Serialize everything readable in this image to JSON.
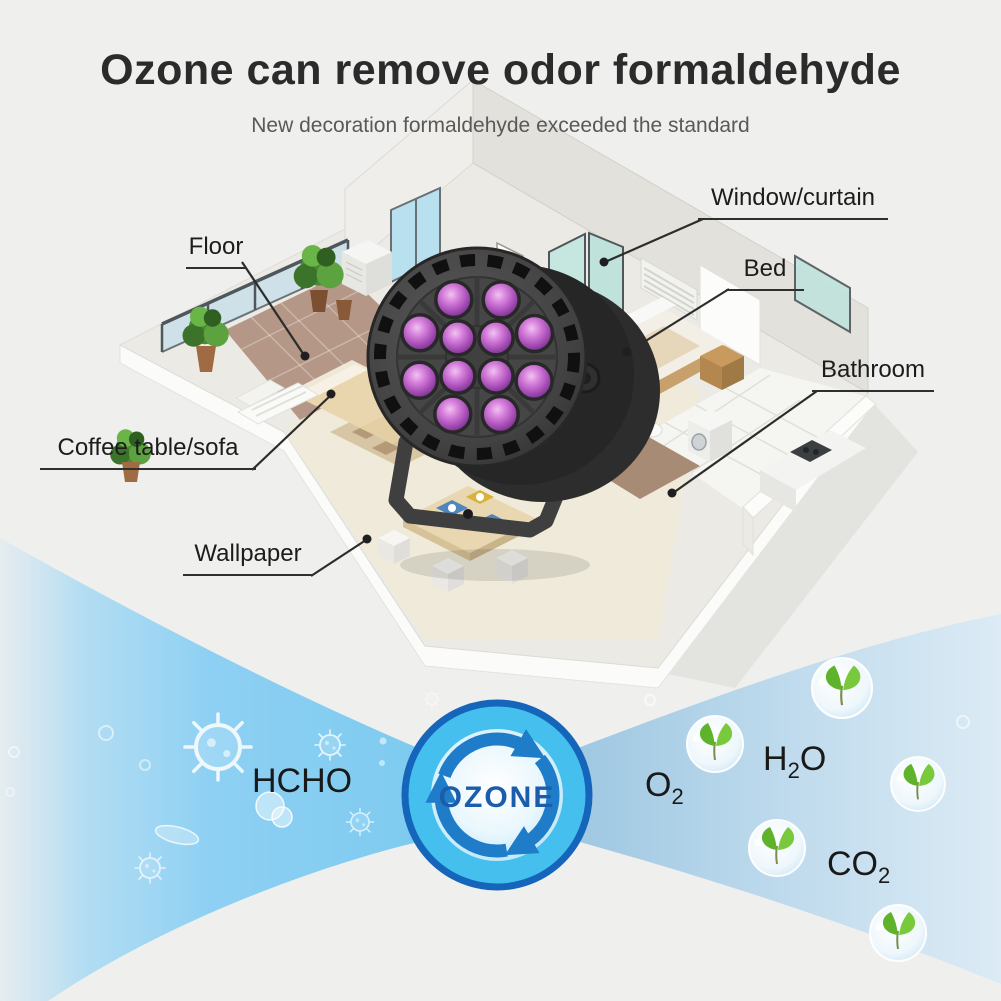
{
  "header": {
    "title": "Ozone can remove odor formaldehyde",
    "subtitle": "New decoration formaldehyde exceeded the standard"
  },
  "house_labels": {
    "floor": "Floor",
    "window_curtain": "Window/curtain",
    "bed": "Bed",
    "bathroom": "Bathroom",
    "coffee_table_sofa": "Coffee table/sofa",
    "wallpaper": "Wallpaper"
  },
  "process": {
    "input_gas": "HCHO",
    "generator_label": "OZONE",
    "outputs": {
      "o2": {
        "base": "O",
        "sub": "2"
      },
      "h2o": {
        "part1": "H",
        "sub": "2",
        "part2": "O"
      },
      "co2": {
        "base": "CO",
        "sub": "2"
      }
    }
  },
  "colors": {
    "background": "#efefee",
    "title_text": "#2b2b2b",
    "subtitle_text": "#595959",
    "label_text": "#1c1c1c",
    "formula_text": "#191919",
    "ozone_text": "#1b5cab",
    "ozone_ring": "#1565bb",
    "ozone_fill": "#45bfee",
    "arrow_blue": "#1e7cc9",
    "band_left_blue": "#7ecbf0",
    "band_right_blue": "#bcd9ec",
    "led_purple": "#a94fb8",
    "lamp_body_gray": "#3f3f3f",
    "leaf_green": "#5fb32a"
  }
}
